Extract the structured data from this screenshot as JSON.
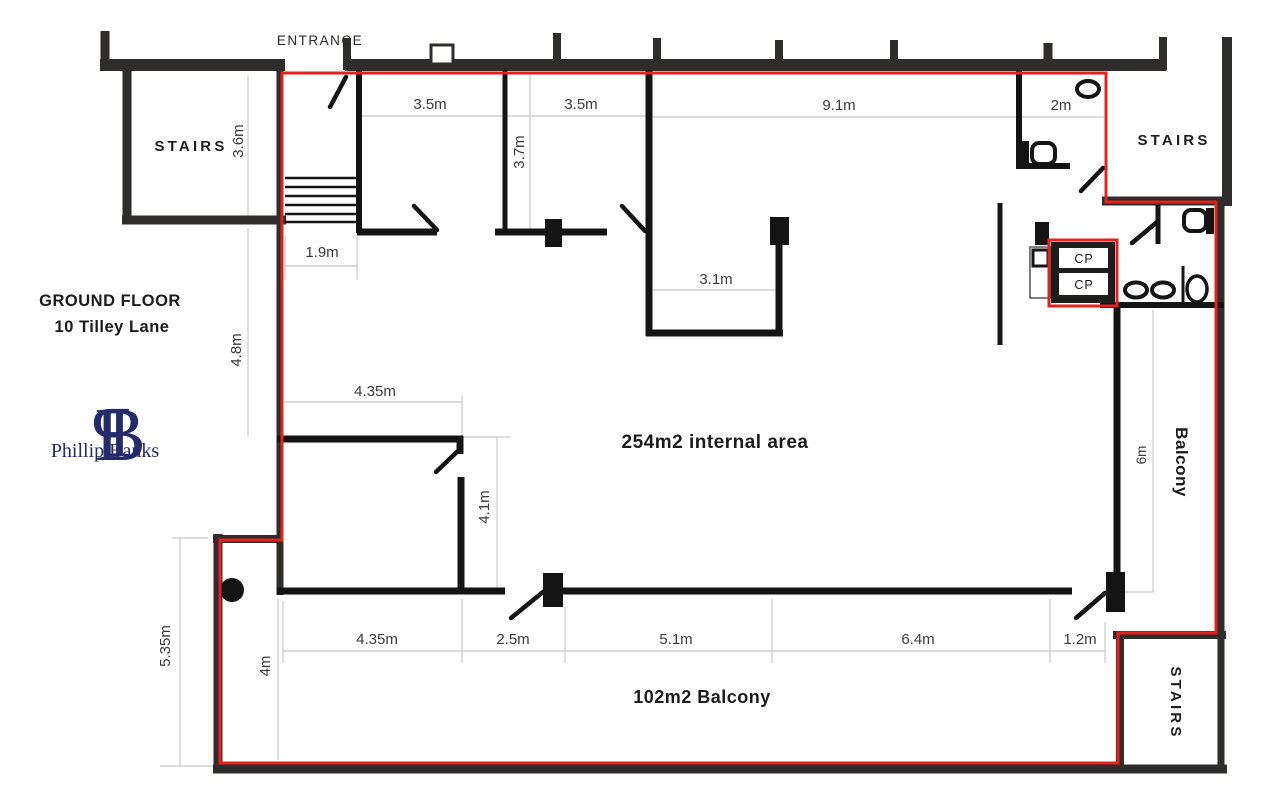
{
  "header": {
    "floor": "GROUND FLOOR",
    "address": "10 Tilley Lane"
  },
  "logo": {
    "monogram_left": "P",
    "monogram_right": "B",
    "name": "Phillip Banks"
  },
  "plan": {
    "entrance_label": "ENTRANCE",
    "internal_area_label": "254m2 internal area",
    "balcony_area_label": "102m2 Balcony",
    "balcony_side_label": "Balcony",
    "stairs_top_left": "STAIRS",
    "stairs_top_right": "STAIRS",
    "stairs_bottom_right": "STAIRS",
    "cupboard_top": "CP",
    "cupboard_bottom": "CP"
  },
  "dimensions": {
    "top_row": [
      "3.5m",
      "3.5m",
      "9.1m",
      "2m"
    ],
    "verticals": {
      "stairs_room": "3.6m",
      "front_room": "3.7m",
      "left_upper": "4.8m",
      "inner_room": "4.1m",
      "left_lower": "5.35m",
      "balcony_left": "4m",
      "balcony_right": "6m"
    },
    "mid": {
      "stair_hall_width": "1.9m",
      "store_width": "3.1m",
      "inner_room_width": "4.35m"
    },
    "bottom_row": [
      "4.35m",
      "2.5m",
      "5.1m",
      "6.4m",
      "1.2m"
    ]
  },
  "colors": {
    "boundary": "#e8201c",
    "outer_wall": "#2e2d2b",
    "inner_wall": "#141414",
    "dimension_line": "#c8c8c8",
    "logo_navy": "#252a6b"
  }
}
